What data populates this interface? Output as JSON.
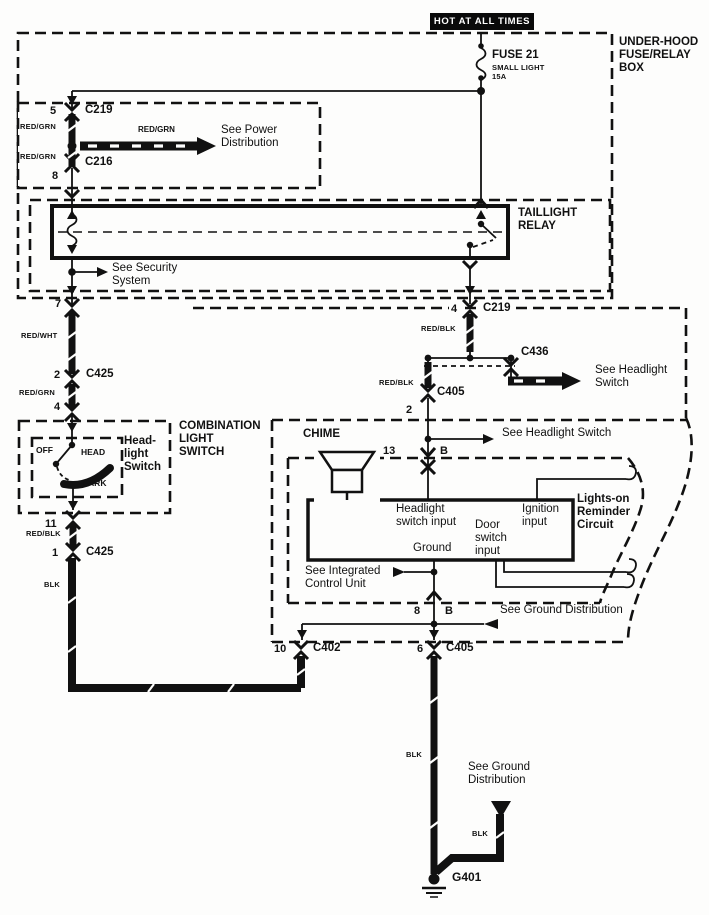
{
  "banner": {
    "hot": "HOT AT ALL TIMES"
  },
  "fuse_box": {
    "name": "UNDER-HOOD\nFUSE/RELAY\nBOX",
    "fuse_name": "FUSE 21",
    "fuse_type": "SMALL LIGHT",
    "fuse_rating": "15A"
  },
  "power_strip": {
    "pin5": "5",
    "c219": "C219",
    "wire_left_top": "RED/GRN",
    "arrow_wire": "RED/GRN",
    "see_power": "See Power\nDistribution",
    "c216": "C216",
    "wire_left_bottom": "RED/GRN",
    "pin8": "8"
  },
  "relay": {
    "name": "TAILLIGHT\nRELAY",
    "see_security": "See Security\nSystem",
    "pin7": "7",
    "pin4": "4",
    "c219": "C219"
  },
  "left_branch": {
    "wire1": "RED/WHT",
    "pin2": "2",
    "c425": "C425",
    "wire2": "RED/GRN",
    "pin4": "4"
  },
  "right_branch": {
    "wire1": "RED/BLK",
    "c436": "C436",
    "wire2": "RED/BLK",
    "c405": "C405",
    "pin2": "2",
    "see_headlight": "See Headlight\nSwitch"
  },
  "combo_switch": {
    "name": "COMBINATION\nLIGHT\nSWITCH",
    "inner_name": "Head-\nlight\nSwitch",
    "pos_off": "OFF",
    "pos_head": "HEAD",
    "pos_park": "PARK",
    "pin11": "11",
    "wire": "RED/BLK",
    "pin1": "1",
    "c425": "C425",
    "wire_blk": "BLK"
  },
  "reminder": {
    "chime": "CHIME",
    "see_headlight": "See Headlight Switch",
    "pin13": "13",
    "conn_b_top": "B",
    "input_headlight": "Headlight\nswitch input",
    "input_door": "Door\nswitch\ninput",
    "ground": "Ground",
    "input_ignition": "Ignition\ninput",
    "name": "Lights-on\nReminder\nCircuit",
    "see_integrated": "See Integrated\nControl Unit",
    "pin8": "8",
    "conn_b_bottom": "B",
    "see_ground": "See Ground Distribution",
    "pin10": "10",
    "c402": "C402",
    "pin6": "6",
    "c405": "C405"
  },
  "ground_path": {
    "wire_blk": "BLK",
    "see_ground": "See Ground\nDistribution",
    "branch_blk": "BLK",
    "g401": "G401"
  },
  "colors": {
    "ink": "#111111",
    "paper": "#fdfdfc"
  }
}
